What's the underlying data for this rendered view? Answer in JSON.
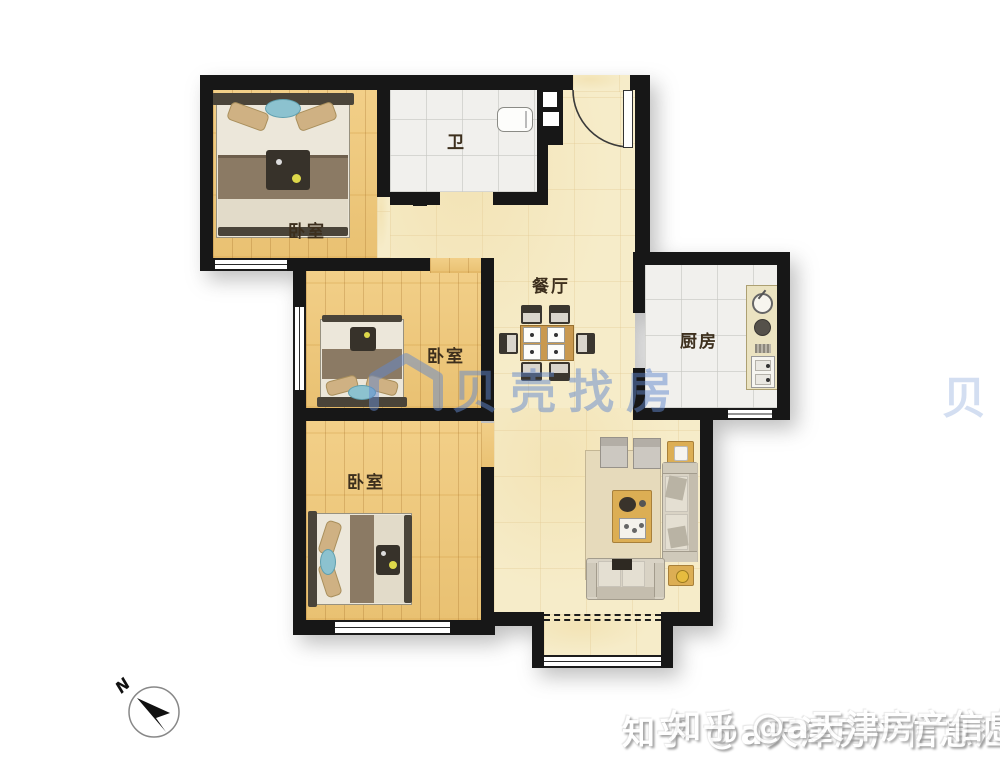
{
  "rooms": {
    "bedroom_top": {
      "label": "卧室"
    },
    "bedroom_middle": {
      "label": "卧室"
    },
    "bedroom_bottom": {
      "label": "卧室"
    },
    "bathroom": {
      "label": "卫"
    },
    "dining": {
      "label": "餐厅"
    },
    "kitchen": {
      "label": "厨房"
    }
  },
  "watermark": {
    "brand": "贝壳找房",
    "partial": "贝"
  },
  "credit": {
    "text": "知乎 @a天津房产信息汇"
  },
  "compass": {
    "north_label": "N"
  },
  "colors": {
    "wall": "#171717",
    "wood": "#e9c172",
    "tile": "#f1f0ed",
    "hall": "#f6ecc9",
    "label": "#3d2f1d",
    "watermark_blue": "#6287cd"
  }
}
